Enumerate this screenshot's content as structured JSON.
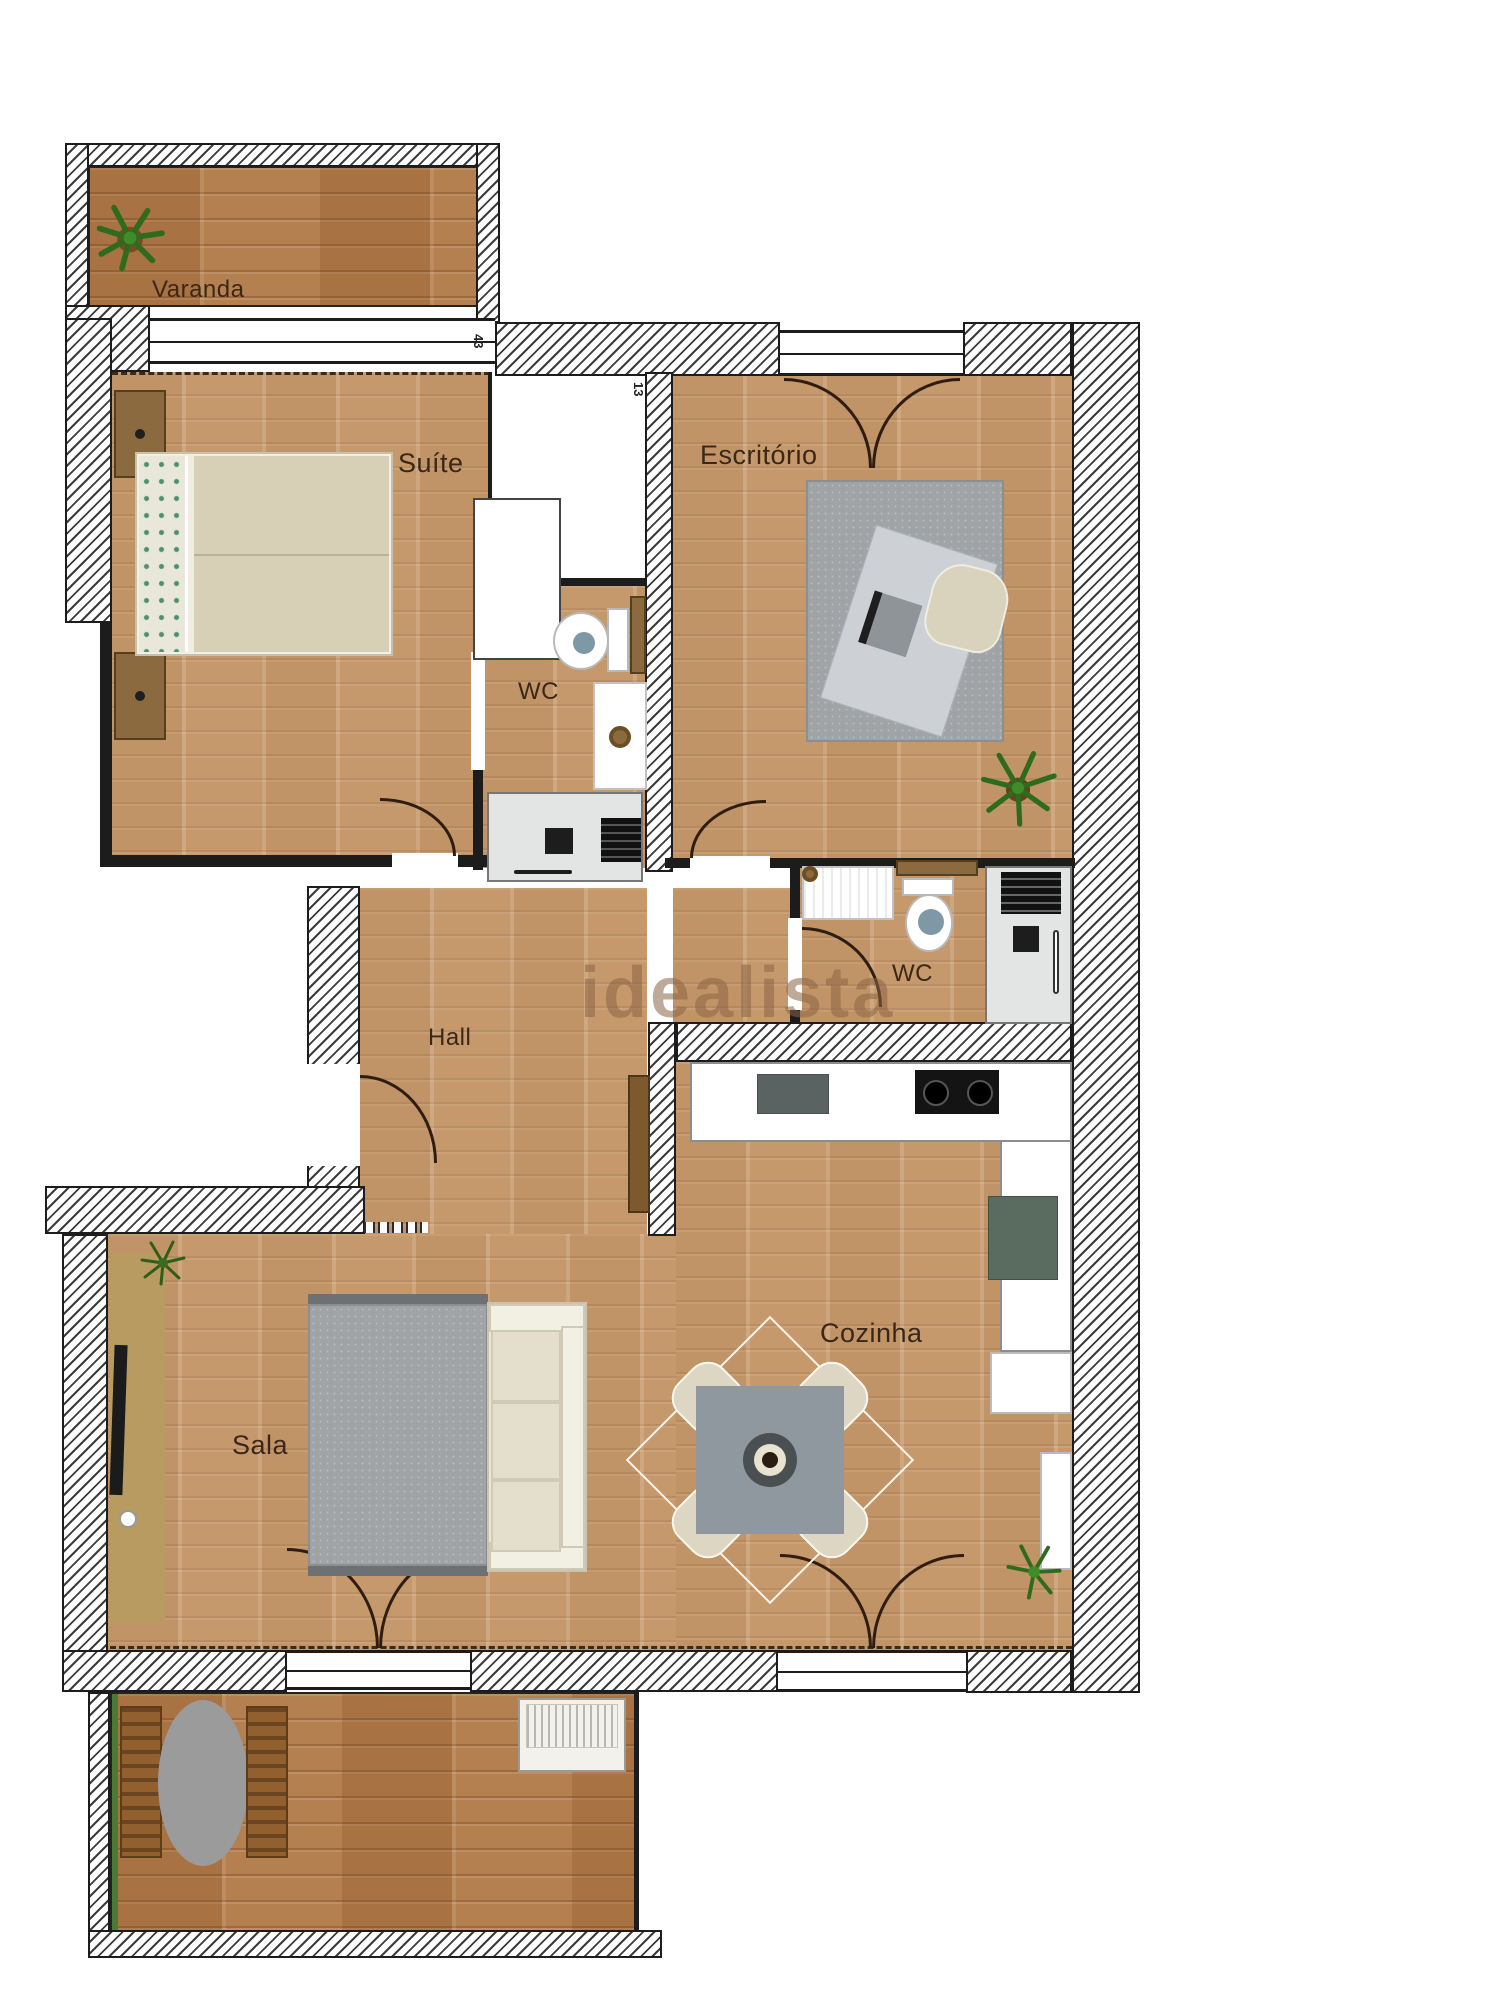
{
  "plan": {
    "watermark": "idealista",
    "rooms": {
      "varanda": "Varanda",
      "suite": "Suíte",
      "escritorio": "Escritório",
      "wc_suite": "WC",
      "wc_service": "WC",
      "hall": "Hall",
      "sala": "Sala",
      "cozinha": "Cozinha"
    },
    "annotations": {
      "dim_a": "43",
      "dim_b": "13"
    },
    "colors": {
      "floor_wood": "#c99e72",
      "deck_wood": "#b5804f",
      "wall_line": "#1c1c1c",
      "rug_gray": "#a0a4a7",
      "sofa_beige": "#eae6d7",
      "table_gray": "#8f989f",
      "label_brown": "#3a2718",
      "plant_green": "#3f7d2c",
      "appliance_green": "#5a6b5f",
      "watermark_brown": "#8b6546"
    }
  }
}
